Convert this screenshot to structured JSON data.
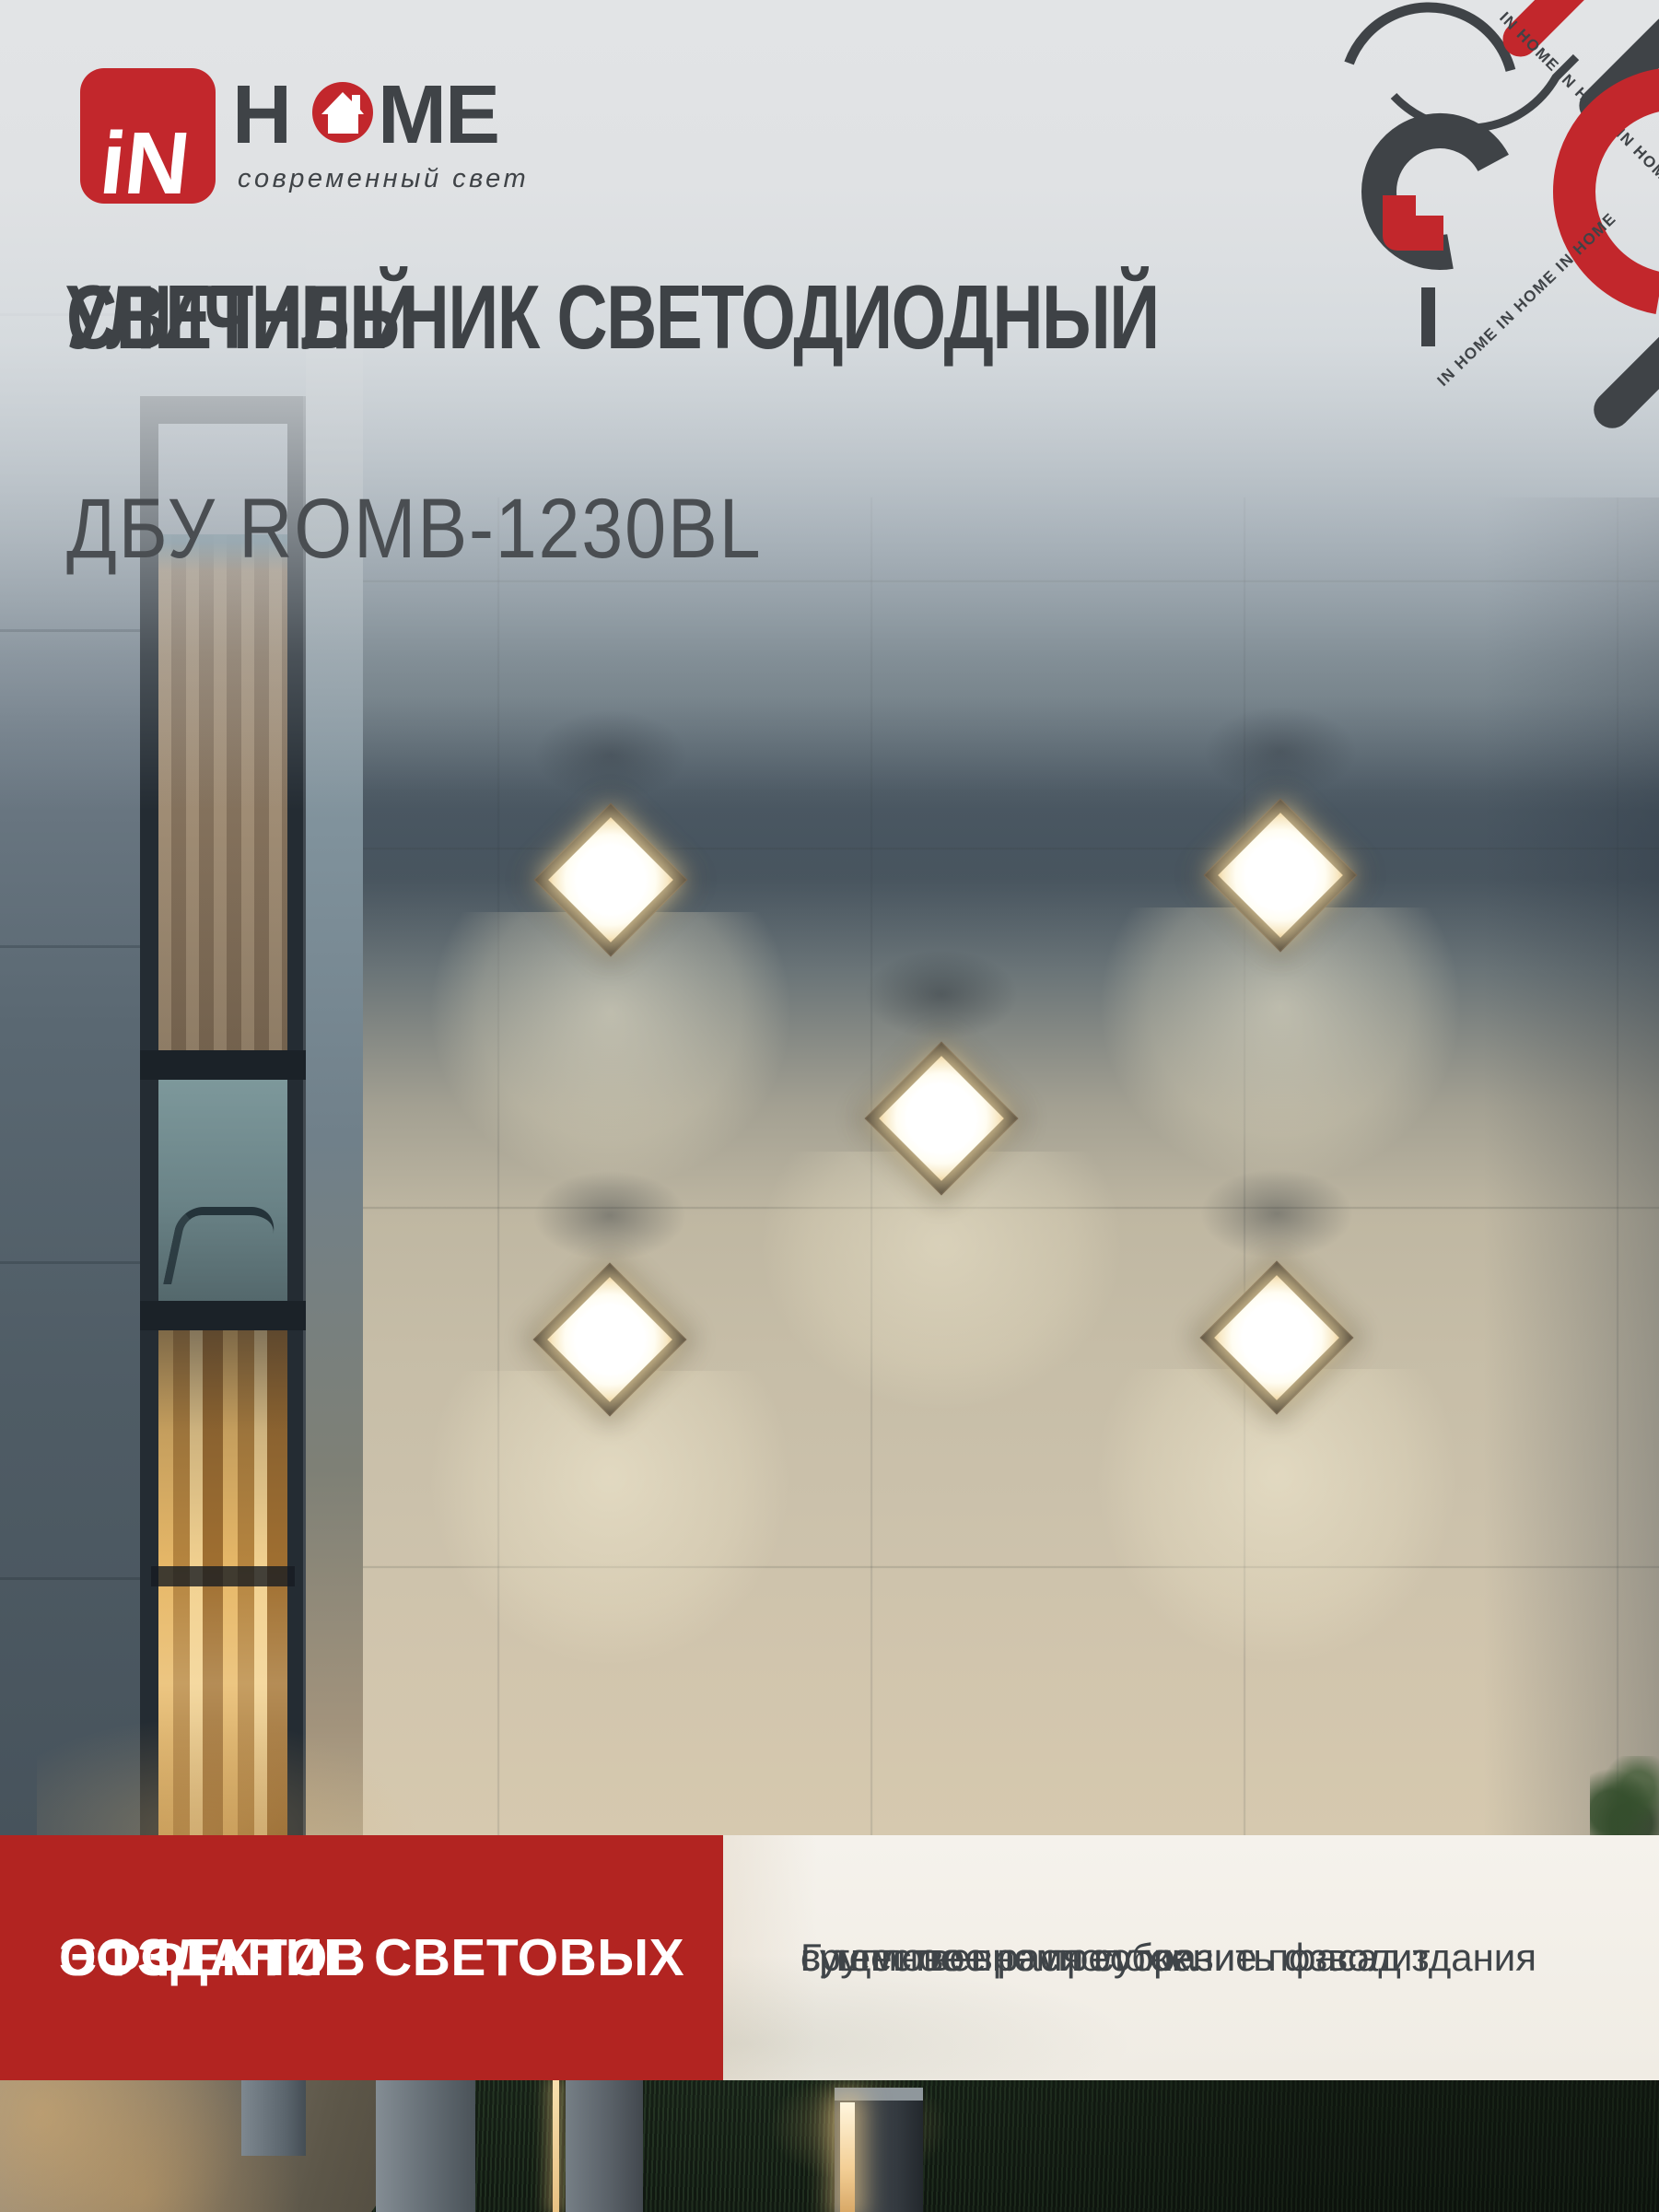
{
  "brand": {
    "logo_in": "iN",
    "logo_h": "H",
    "logo_me": "ME",
    "tagline": "современный свет",
    "decor_text_top": "IN HOME  IN HOME  IN HOME",
    "decor_text_bottom": "IN HOME  IN HOME  IN HOME"
  },
  "header": {
    "title_line1": "СВЕТИЛЬНИК СВЕТОДИОДНЫЙ",
    "title_line2": "УЛИЧНЫЙ",
    "model": "ДБУ ROMB-1230BL"
  },
  "feature_banner": {
    "heading_line1": "СОЗДАНИЕ СВЕТОВЫХ",
    "heading_line2": "ЭФФЕКТОВ",
    "description_line1": "Групповое расположение позволит",
    "description_line2": "существенно преобразить фасад здания",
    "description_line3": "в темное время суток."
  },
  "colors": {
    "brand_red": "#c2272c",
    "banner_red": "#b22421",
    "dark_gray": "#3f4347",
    "panel_bg": "#f3f0ea"
  }
}
